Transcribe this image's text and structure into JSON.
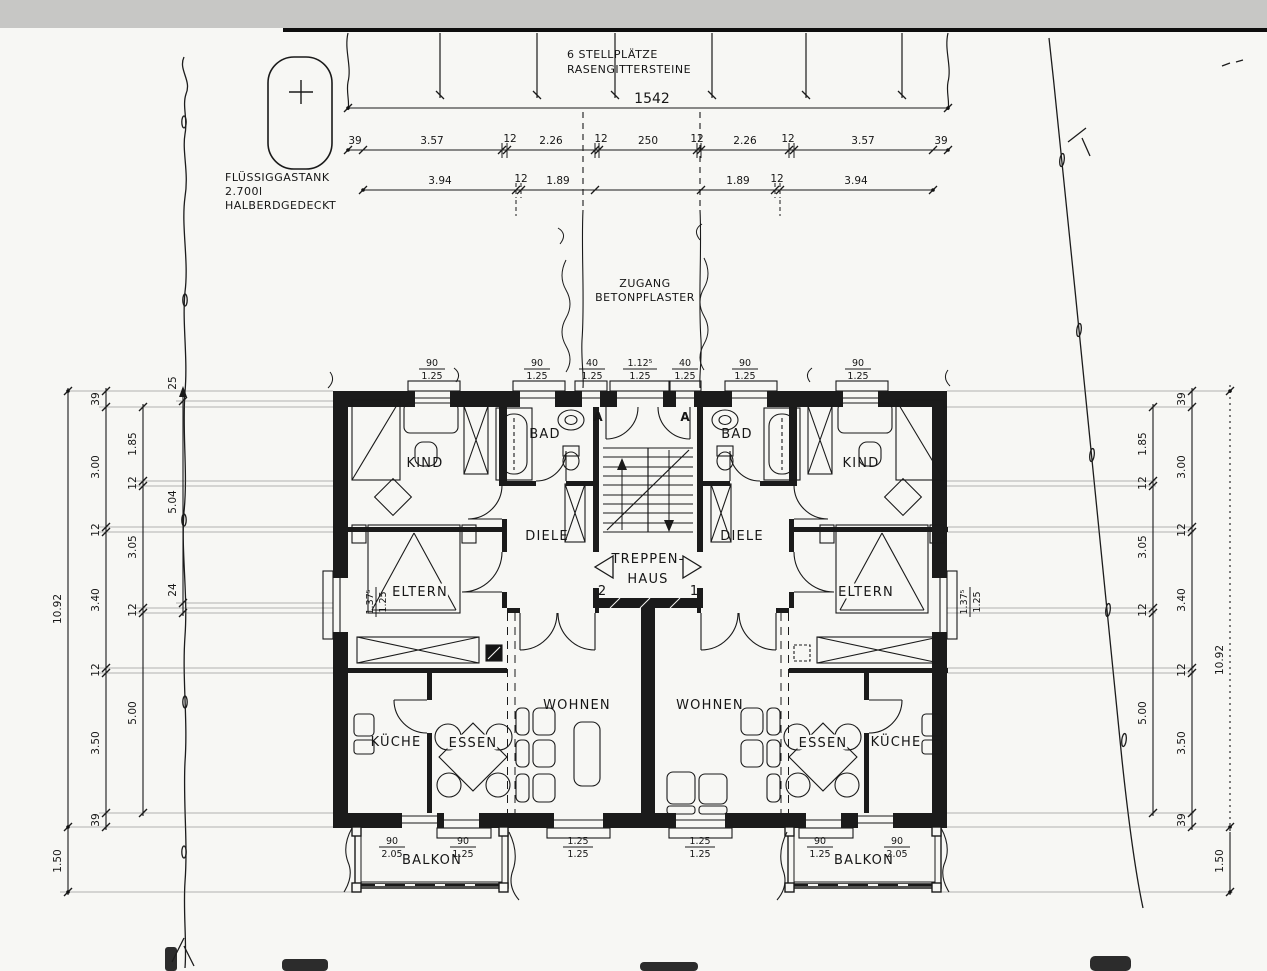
{
  "site": {
    "parking_line1": "6 STELLPLÄTZE",
    "parking_line2": "RASENGITTERSTEINE",
    "tank_line1": "FLÜSSIGGASTANK",
    "tank_line2": "2.700l",
    "tank_line3": "HALBERDGEDECKT",
    "access_line1": "ZUGANG",
    "access_line2": "BETONPFLASTER"
  },
  "dims": {
    "total": "1542",
    "row1": [
      "39",
      "3.57",
      "12",
      "2.26",
      "12",
      "250",
      "12",
      "2.26",
      "12",
      "3.57",
      "39"
    ],
    "row2": [
      "3.94",
      "12",
      "1.89",
      "1.89",
      "12",
      "3.94"
    ],
    "leftOuter": "10.92",
    "leftA": [
      "39",
      "3.00",
      "12",
      "3.40",
      "12",
      "3.50",
      "39"
    ],
    "leftB": [
      "1.85",
      "12",
      "3.05",
      "12",
      "5.00"
    ],
    "leftC": [
      "25",
      "5.04",
      "24"
    ],
    "leftBalcony": "1.50",
    "rightOuter": "10.92",
    "rightA": [
      "39",
      "3.00",
      "12",
      "3.40",
      "12",
      "3.50",
      "39"
    ],
    "rightB": [
      "1.85",
      "12",
      "3.05",
      "12",
      "5.00"
    ],
    "rightBalcony": "1.50",
    "winTop": [
      {
        "n": "90",
        "d": "1.25"
      },
      {
        "n": "90",
        "d": "1.25"
      },
      {
        "n": "40",
        "d": "1.25"
      },
      {
        "n": "1.12⁵",
        "d": "1.25"
      },
      {
        "n": "40",
        "d": "1.25"
      },
      {
        "n": "90",
        "d": "1.25"
      },
      {
        "n": "90",
        "d": "1.25"
      }
    ],
    "winBottom": [
      {
        "n": "90",
        "d": "2.05"
      },
      {
        "n": "90",
        "d": "1.25"
      },
      {
        "n": "1.25",
        "d": "1.25"
      },
      {
        "n": "1.25",
        "d": "1.25"
      },
      {
        "n": "90",
        "d": "1.25"
      },
      {
        "n": "90",
        "d": "2.05"
      }
    ],
    "winSideLeft": {
      "n": "1.37⁵",
      "d": "1.25"
    },
    "winSideRight": {
      "n": "1.37⁵",
      "d": "1.25"
    }
  },
  "rooms": {
    "kindLeft": "KIND",
    "badLeft": "BAD",
    "dieleLeft": "DIELE",
    "elternLeft": "ELTERN",
    "wohnenLeft": "WOHNEN",
    "kuecheLeft": "KÜCHE",
    "essenLeft": "ESSEN",
    "balkonLeft": "BALKON",
    "kindRight": "KIND",
    "badRight": "BAD",
    "dieleRight": "DIELE",
    "elternRight": "ELTERN",
    "wohnenRight": "WOHNEN",
    "kuecheRight": "KÜCHE",
    "essenRight": "ESSEN",
    "balkonRight": "BALKON"
  },
  "stair": {
    "line1": "TREPPEN-",
    "line2": "HAUS",
    "doorLeft": "2",
    "doorRight": "1",
    "markerLeft": "A",
    "markerRight": "A"
  }
}
